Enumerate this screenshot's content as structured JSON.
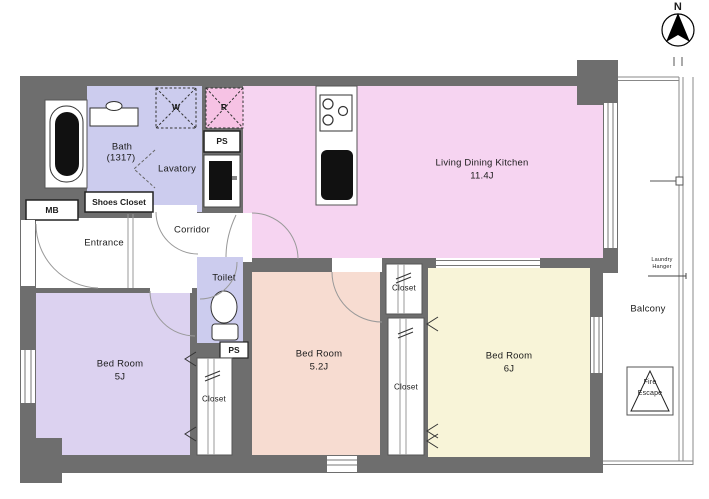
{
  "compass": {
    "north_label": "N"
  },
  "rooms": {
    "ldk": {
      "name": "Living Dining Kitchen",
      "size": "11.4J"
    },
    "bath": {
      "name": "Bath",
      "size": "(1317)"
    },
    "lavatory": {
      "name": "Lavatory"
    },
    "toilet": {
      "name": "Toilet"
    },
    "entrance": {
      "name": "Entrance"
    },
    "corridor": {
      "name": "Corridor"
    },
    "bedroom_5j": {
      "name": "Bed Room",
      "size": "5J"
    },
    "bedroom_5_2j": {
      "name": "Bed Room",
      "size": "5.2J"
    },
    "bedroom_6j": {
      "name": "Bed Room",
      "size": "6J"
    },
    "balcony": {
      "name": "Balcony"
    }
  },
  "features": {
    "meter_box": "MB",
    "shoes_closet": "Shoes Closet",
    "pipe_space_upper": "PS",
    "pipe_space_toilet": "PS",
    "washing_machine": "W",
    "refrigerator": "R",
    "closet_bedroom_5j": "Closet",
    "closet_mid_upper": "Closet",
    "closet_mid_lower": "Closet",
    "laundry_hanger": [
      "Laundry",
      "Hanger"
    ],
    "fire_escape": [
      "Fire",
      "Escape"
    ]
  },
  "colors": {
    "wall": "#6e6e6e",
    "wet": "#ccccee",
    "ldk": "#f6d4f1",
    "fridge": "#f6c2e4",
    "bed1": "#dcd2f0",
    "bed2": "#f7dcd1",
    "bed3": "#f8f4d8",
    "line": "#555555"
  }
}
